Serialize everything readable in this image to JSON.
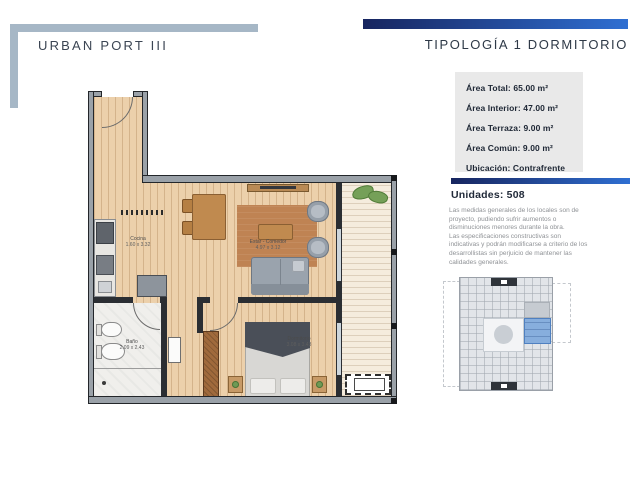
{
  "header": {
    "left_title": "URBAN PORT III",
    "right_title": "TIPOLOGÍA 1 DORMITORIO",
    "steel_accent": "#a6b7c6",
    "blue_gradient_start": "#17255f",
    "blue_gradient_end": "#2f6fd2"
  },
  "info_panel": {
    "bg": "#e9e9e9",
    "text_color": "#1d2634",
    "lines": [
      "Área Total: 65.00 m²",
      "Área Interior: 47.00 m²",
      "Área Terraza: 9.00 m²",
      "Área Común: 9.00 m²",
      "Ubicación: Contrafrente"
    ]
  },
  "units": {
    "label": "Unidades: 508"
  },
  "disclaimer": {
    "p1": "Las medidas generales de los locales son de proyecto, pudiendo sufrir aumentos o disminuciones menores durante la obra.",
    "p2": "Las especificaciones constructivas son indicativas y podrán modificarse a criterio de los desarrollistas sin perjuicio de mantener las calidades generales."
  },
  "floor_plan": {
    "rooms": [
      {
        "name": "Cocina",
        "dims": "1.60 x 3.32"
      },
      {
        "name": "Estar - Comedor",
        "dims": "4.97 x 3.12"
      },
      {
        "name": "Baño",
        "dims": "2.09 x 2.43"
      },
      {
        "name": "Dormitorio",
        "dims": "3.08 x 3.43"
      }
    ],
    "wood_color": "#ecd0ab",
    "wall_color": "#9aa1a8"
  },
  "key_plan": {
    "highlight_color": "#87aedd"
  }
}
